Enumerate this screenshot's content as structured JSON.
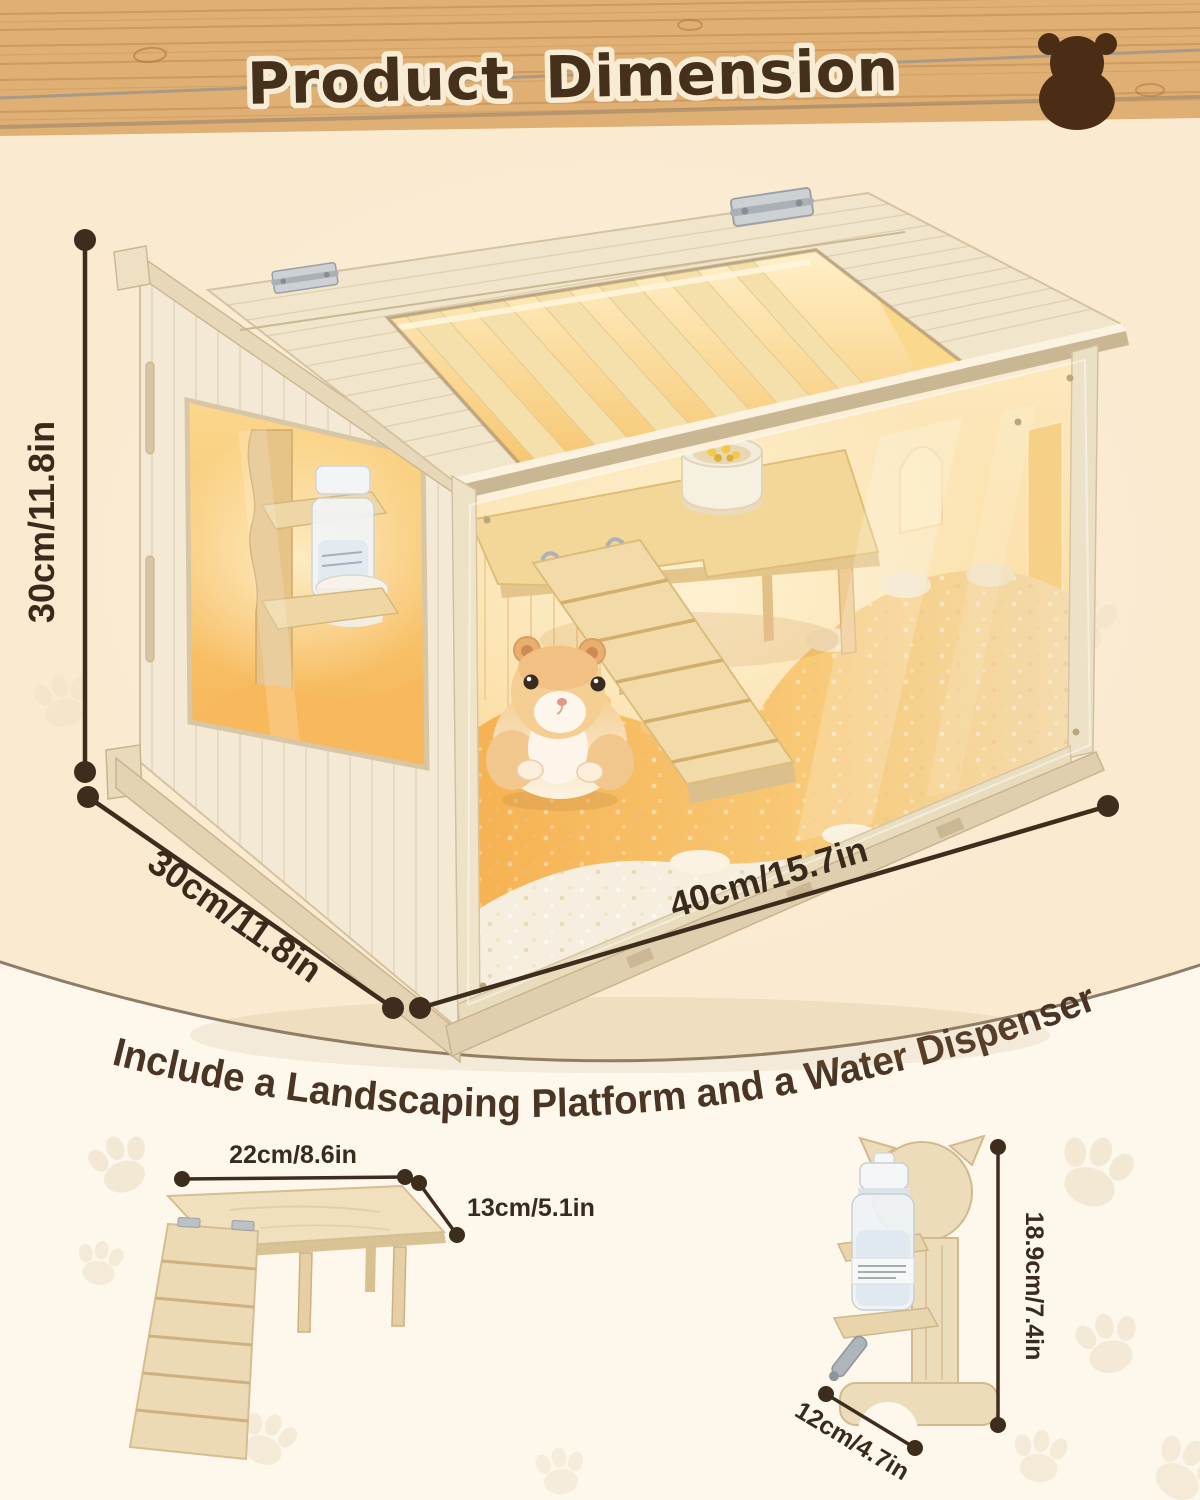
{
  "header": {
    "title": "Product Dimension"
  },
  "hero": {
    "height_label": "30cm/11.8in",
    "depth_label": "30cm/11.8in",
    "width_label": "40cm/15.7in"
  },
  "tagline": {
    "text": "Include a Landscaping Platform and a Water Dispenser"
  },
  "platform": {
    "width_label": "22cm/8.6in",
    "depth_label": "13cm/5.1in"
  },
  "dispenser": {
    "height_label": "18.9cm/7.4in",
    "base_label": "12cm/4.7in"
  },
  "icons": {
    "header_logo": "bear-icon",
    "background_motif": "paw-print-icon"
  },
  "colors": {
    "dimension_ink": "#3a2a1b",
    "title_ink": "#45301b",
    "title_outline": "#f8ecd4",
    "header_wood": "#dfaf74",
    "panel_cream": "#f9ead0",
    "page_cream": "#fdf7ec",
    "arc_stroke": "#8d7c66"
  }
}
